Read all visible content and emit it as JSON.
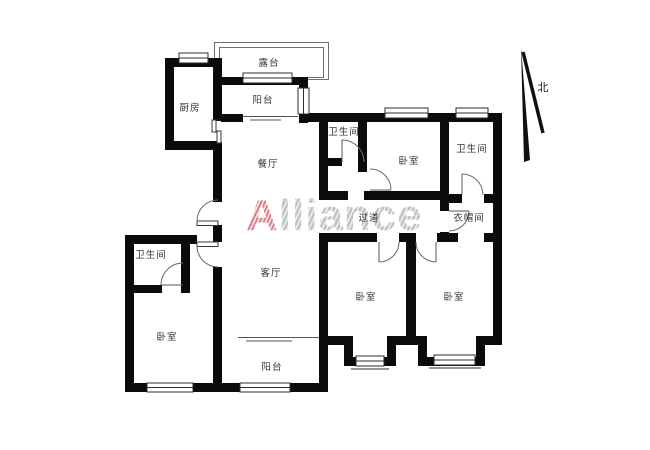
{
  "watermark": {
    "brand_first_letter": "A",
    "brand_rest": "lliance"
  },
  "compass": {
    "north_label": "北"
  },
  "rooms": {
    "terrace": "露台",
    "balcony_top": "阳台",
    "kitchen": "厨房",
    "dining": "餐厅",
    "bathroom_mid": "卫生间",
    "bedroom_top": "卧室",
    "bathroom_topright": "卫生间",
    "hallway": "过道",
    "cloakroom": "衣帽间",
    "living": "客厅",
    "bathroom_left": "卫生间",
    "bedroom_left": "卧室",
    "bedroom_mid": "卧室",
    "bedroom_right": "卧室",
    "balcony_bottom": "阳台"
  }
}
